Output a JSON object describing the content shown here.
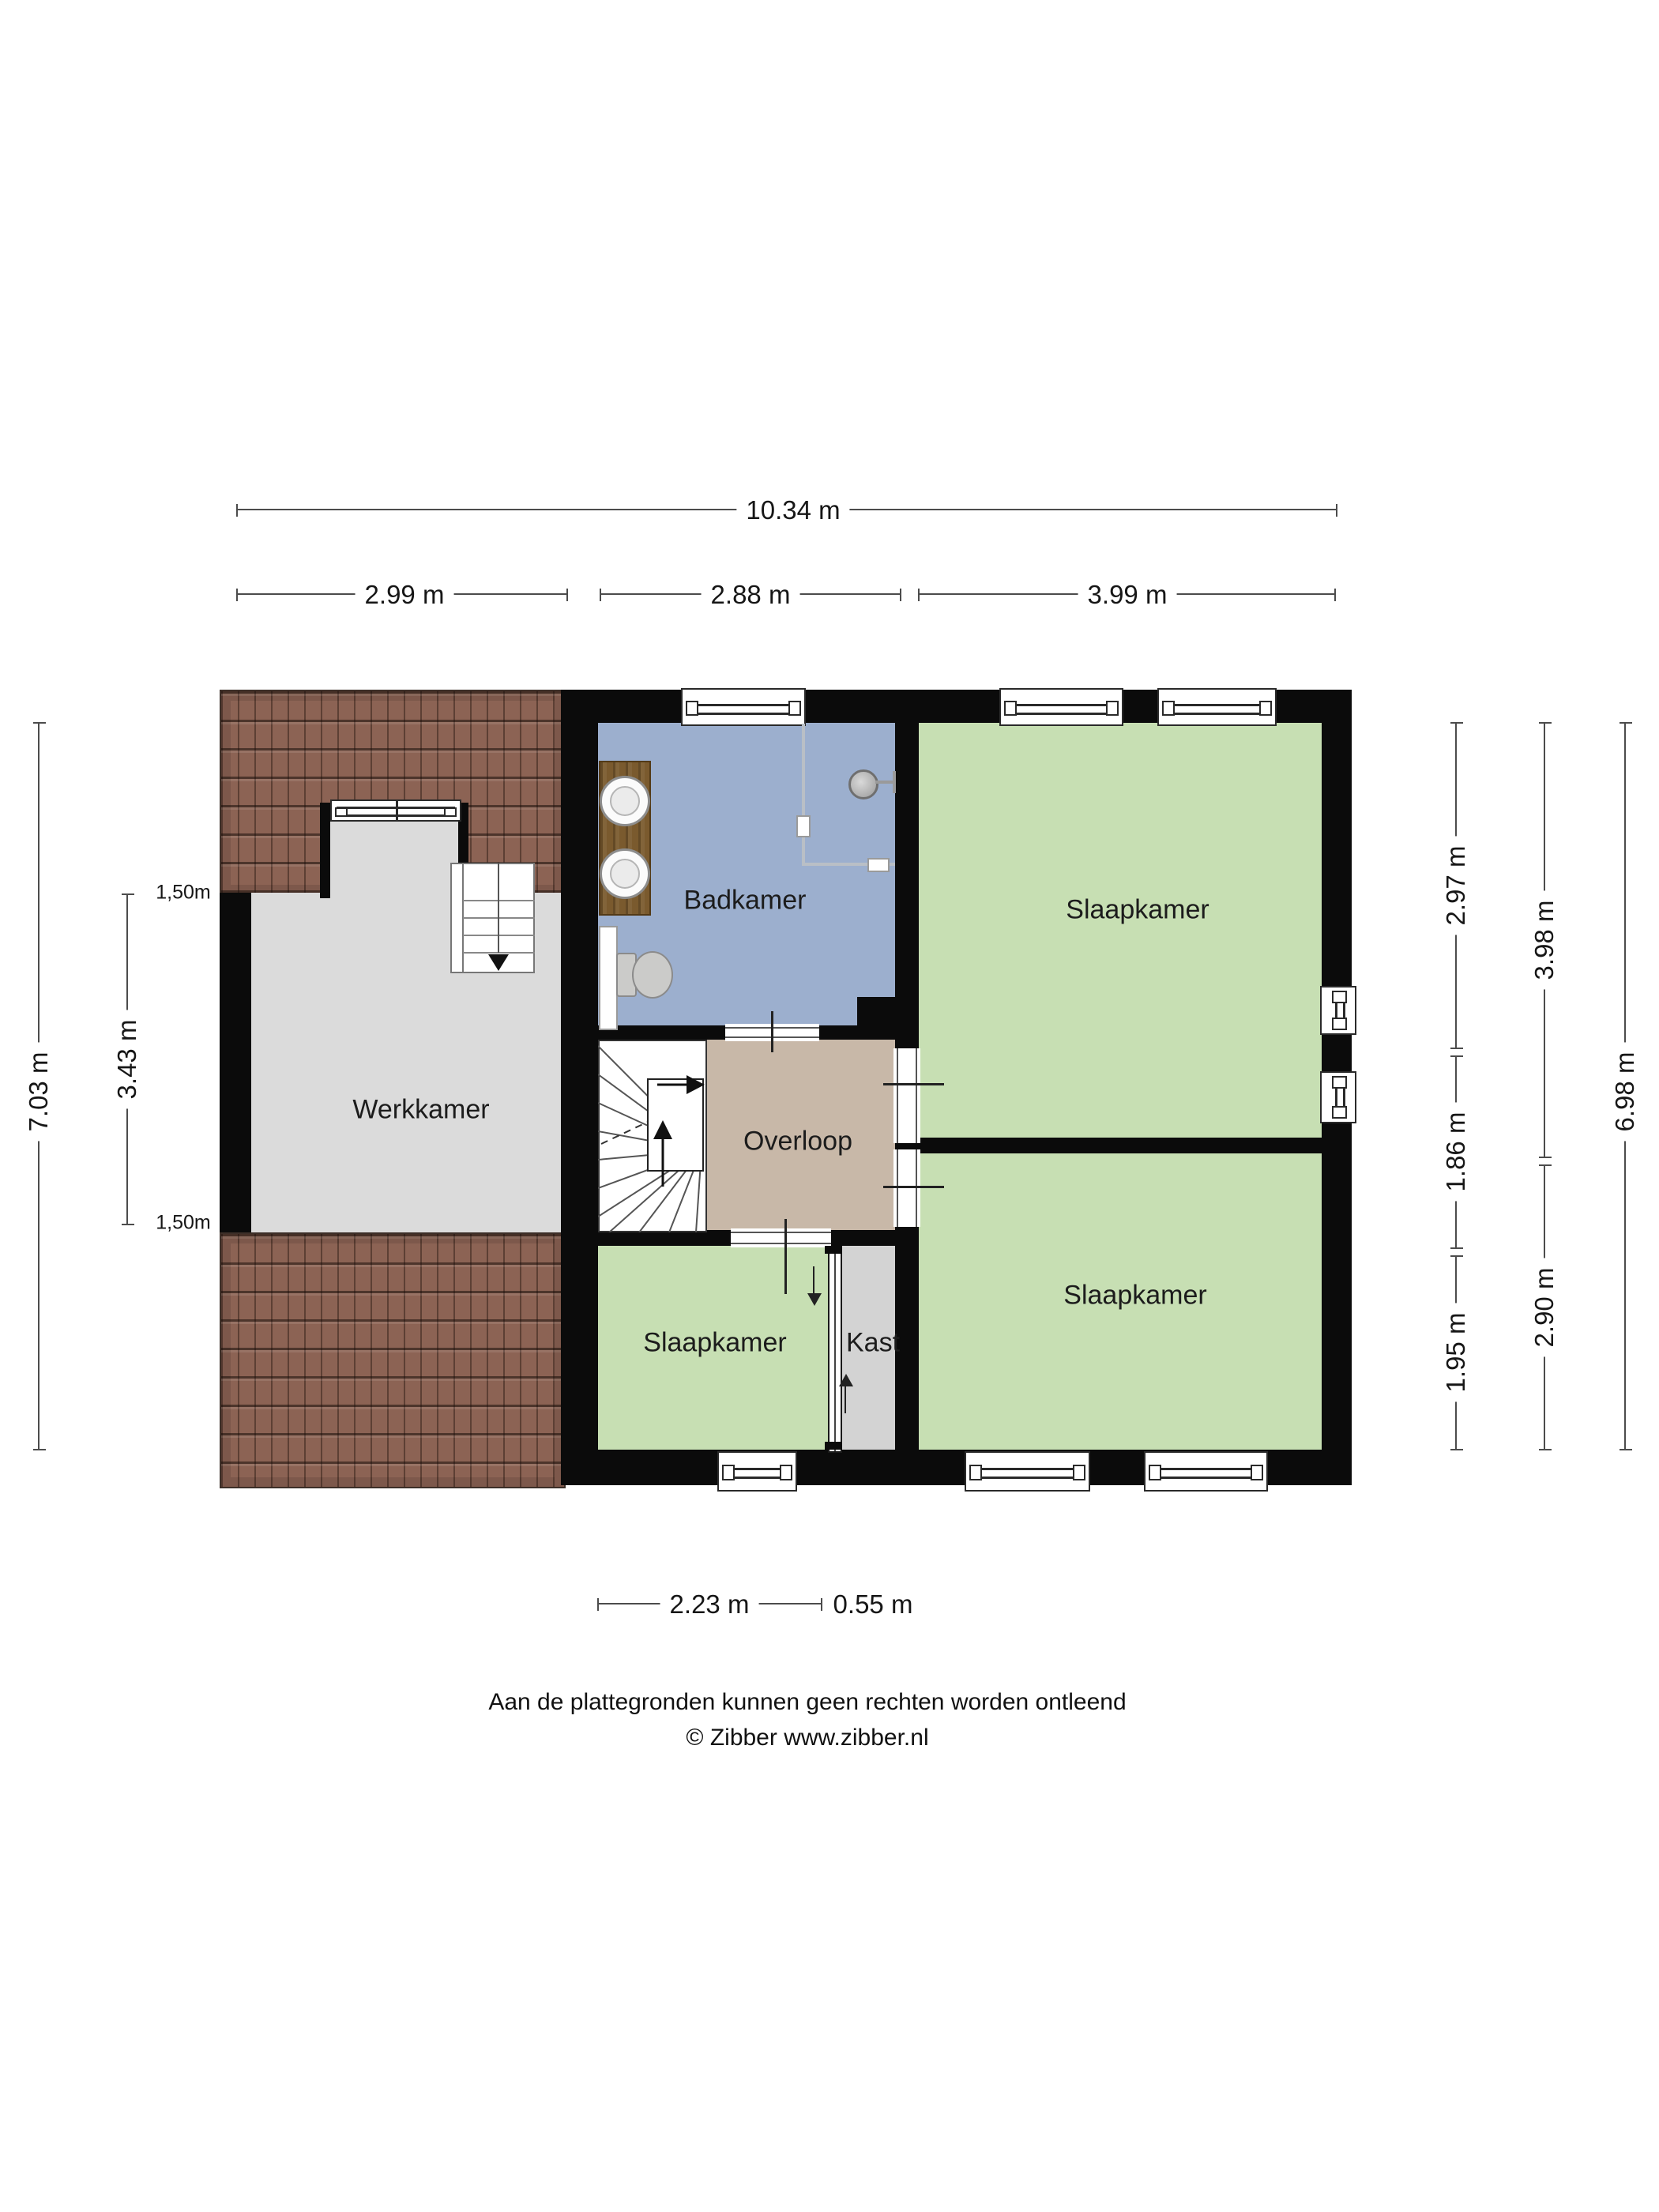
{
  "rooms": {
    "werkkamer": {
      "label": "Werkkamer"
    },
    "badkamer": {
      "label": "Badkamer"
    },
    "slaapkamer_top": {
      "label": "Slaapkamer"
    },
    "slaapkamer_bottom": {
      "label": "Slaapkamer"
    },
    "slaapkamer_small": {
      "label": "Slaapkamer"
    },
    "overloop": {
      "label": "Overloop"
    },
    "kast": {
      "label": "Kast"
    }
  },
  "dimensions": {
    "top_total": "10.34 m",
    "top_segments": [
      "2.99 m",
      "2.88 m",
      "3.99 m"
    ],
    "left_total": "7.03 m",
    "left_middle": "3.43 m",
    "roof_height_top": "1,50m",
    "roof_height_bottom": "1,50m",
    "right_inner": [
      "2.97 m",
      "1.86 m",
      "1.95 m"
    ],
    "right_mid": [
      "3.98 m",
      "2.90 m"
    ],
    "right_total": "6.98 m",
    "bottom_segments": [
      "2.23 m",
      "0.55 m"
    ]
  },
  "footer": {
    "disclaimer": "Aan de plattegronden kunnen geen rechten worden ontleend",
    "copyright": "© Zibber www.zibber.nl"
  },
  "colors": {
    "wall": "#0b0b0b",
    "badkamer_floor": "#9cafce",
    "bedroom_floor": "#c7dfb3",
    "overloop_floor": "#c8b8a8",
    "werkkamer_floor": "#dbdbdb",
    "kast_floor": "#d3d3d3",
    "roof_tile": "#8c6354"
  }
}
